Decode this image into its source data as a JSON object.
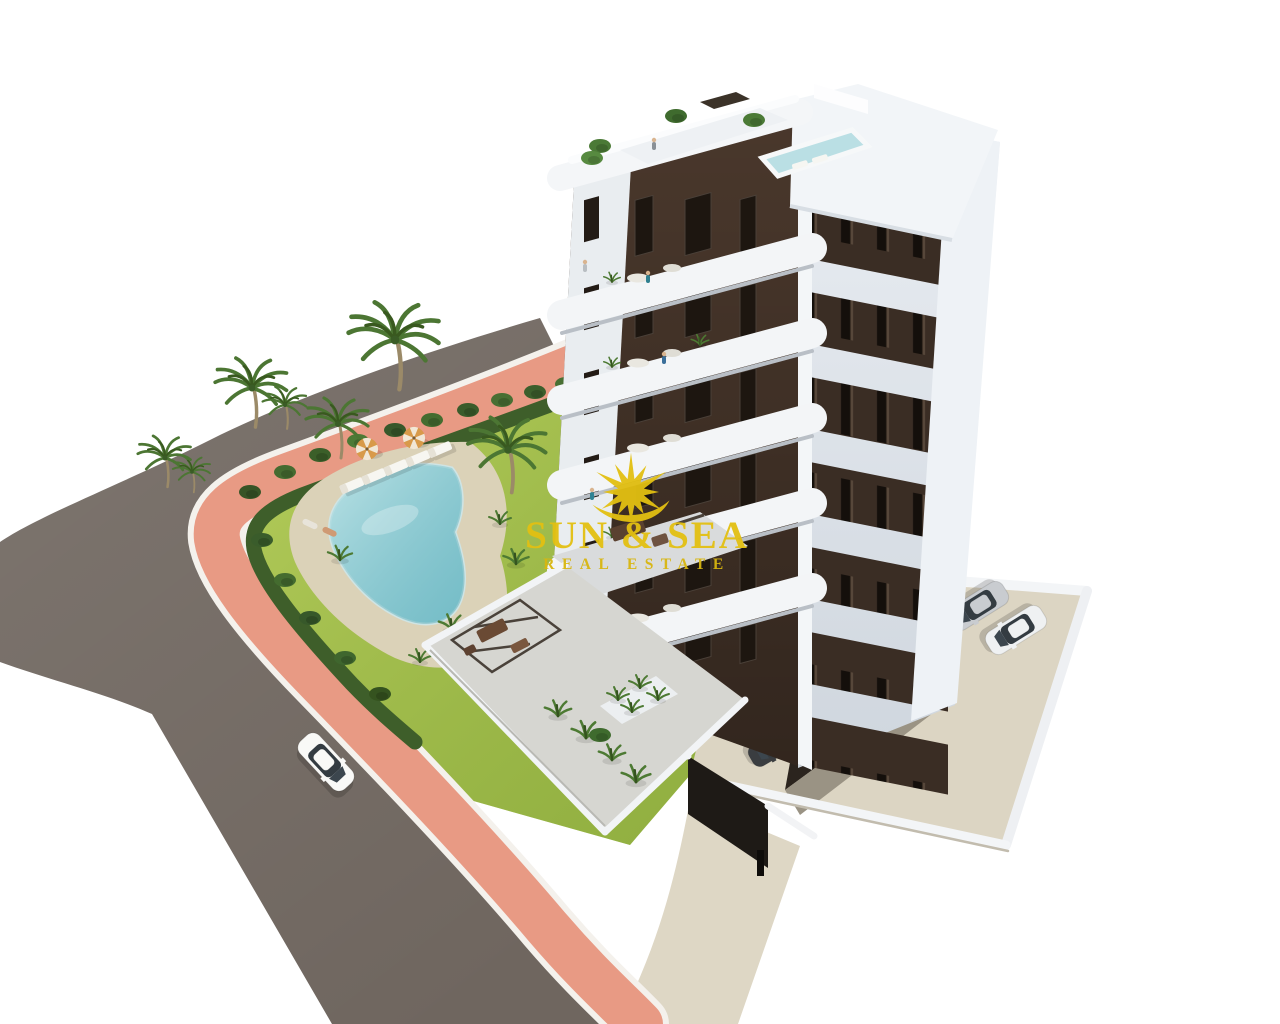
{
  "meta": {
    "kind": "3d-architectural-rendering",
    "width_px": 1280,
    "height_px": 1024,
    "background": "#ffffff"
  },
  "watermark": {
    "icon": "sunburst-icon",
    "title": "SUN & SEA",
    "subtitle": "REAL ESTATE",
    "color": "#e3c012"
  },
  "scene": {
    "description": "Aerial isometric 3D rendering of a modern seven-storey apartment block with dark-brown facade panels and white rounded balconies, a rooftop terrace with plunge pool, a landscaped garden with a free-form swimming pool, sun loungers, striped parasols and palm trees, a pink pedestrian walkway along a curved asphalt road with a white car, and a walled parking area with parked cars.",
    "elements": [
      "apartment-building",
      "rooftop-terrace",
      "rooftop-plunge-pool",
      "balconies",
      "garden-lawn",
      "hedge-border",
      "swimming-pool",
      "pool-deck",
      "sun-loungers",
      "parasols",
      "palm-trees",
      "ground-floor-terrace",
      "pergola",
      "parking-area",
      "parked-cars",
      "covered-parking",
      "asphalt-road",
      "pink-sidewalk",
      "white-car",
      "watermark-logo"
    ]
  },
  "palette": {
    "background": "#ffffff",
    "road": "#6f665f",
    "sidewalk": "#e89a84",
    "lawn": "#a2bf4a",
    "hedge": "#3e5e2a",
    "pool_water": "#8fccd3",
    "pool_deck": "#dbd2b8",
    "facade_brown": "#4a382c",
    "facade_white": "#eef1f4",
    "window_glass": "#1d1610",
    "parking_floor": "#dcd5c3",
    "terrace_floor": "#d6d6d1",
    "roof_pool": "#badfe4",
    "car_white": "#f9f9f7"
  }
}
